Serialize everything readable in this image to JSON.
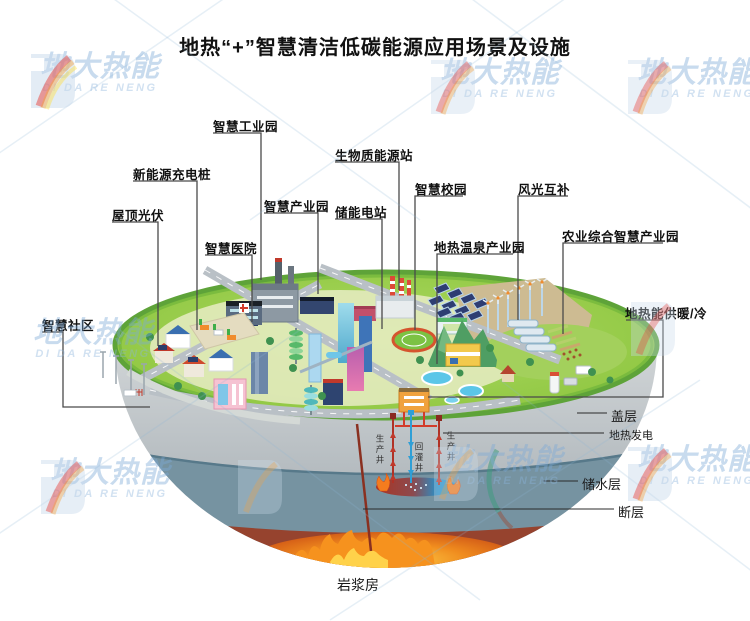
{
  "title": "地热“+”智慧清洁低碳能源应用场景及设施",
  "watermark": {
    "cn": "地大热能",
    "en": "DI DA RE NENG"
  },
  "facility_labels": [
    {
      "label": "智慧工业园"
    },
    {
      "label": "新能源充电桩"
    },
    {
      "label": "屋顶光伏"
    },
    {
      "label": "智慧医院"
    },
    {
      "label": "智慧产业园"
    },
    {
      "label": "智慧社区"
    },
    {
      "label": "生物质能源站"
    },
    {
      "label": "储能电站"
    },
    {
      "label": "智慧校园"
    },
    {
      "label": "风光互补"
    },
    {
      "label": "地热温泉产业园"
    },
    {
      "label": "农业综合智慧产业园"
    },
    {
      "label": "地热能供暖/冷"
    }
  ],
  "geology_labels": [
    {
      "label": "盖层"
    },
    {
      "label": "地热发电"
    },
    {
      "label": "储水层"
    },
    {
      "label": "断层"
    },
    {
      "label": "岩浆房"
    }
  ],
  "well_labels": [
    {
      "label": "生产井"
    },
    {
      "label": "回灌井"
    },
    {
      "label": "生产井"
    }
  ],
  "colors": {
    "surface_green": "#97c949",
    "cap_layer_gray": "#c3c8cc",
    "aquifer_blue": "#7693a1",
    "magma_brown": "#96432e",
    "flame_orange": "#f6921e",
    "production_well_red": "#b03226",
    "injection_well_blue": "#2f9fd6",
    "callout_line": "#4a4a4a"
  }
}
